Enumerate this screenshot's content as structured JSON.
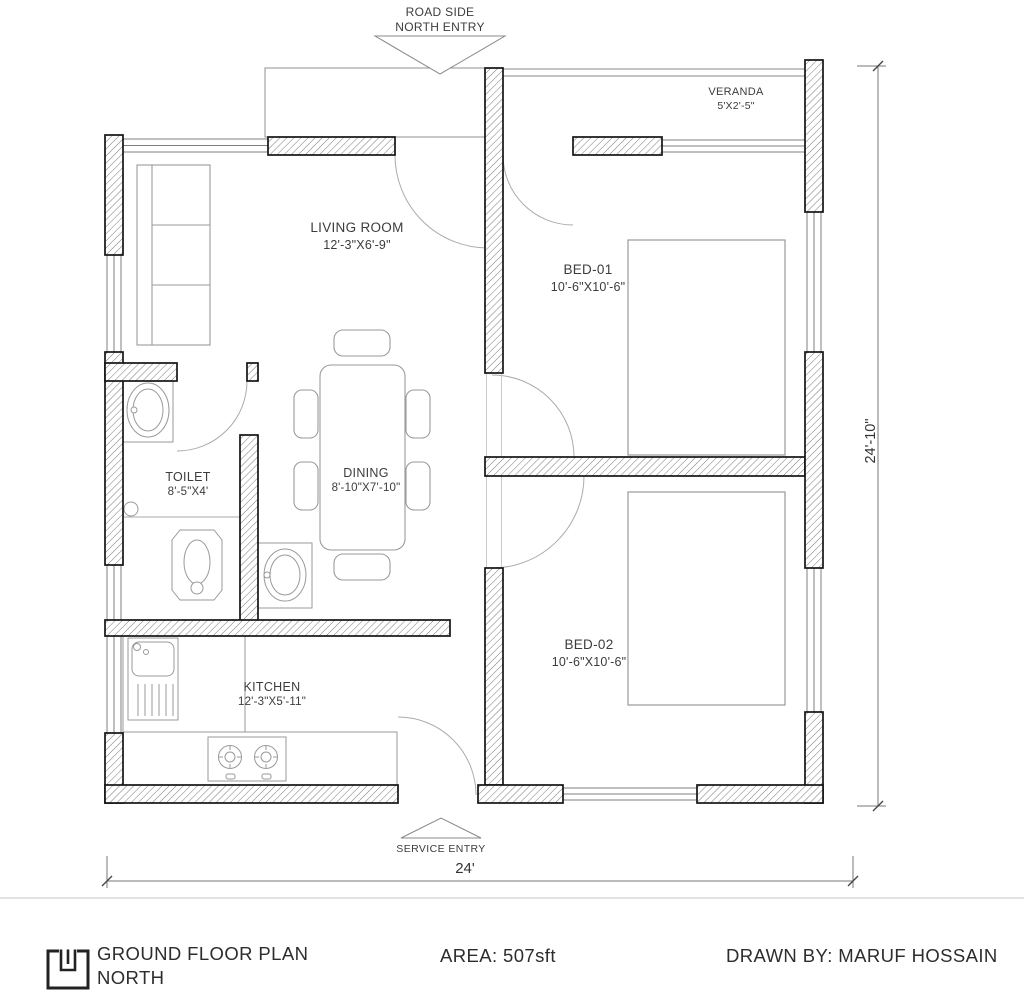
{
  "colors": {
    "wall_line": "#141414",
    "hatch": "#6a6a6a",
    "furniture_line": "#9a9a9a",
    "text": "#3c3c3c"
  },
  "annotations": {
    "north_entry": {
      "line1": "ROAD SIDE",
      "line2": "NORTH ENTRY"
    },
    "service_entry": "SERVICE ENTRY"
  },
  "dimensions": {
    "bottom": "24'",
    "right": "24'-10\""
  },
  "rooms": {
    "living_room": {
      "name": "LIVING ROOM",
      "size": "12'-3\"X6'-9\""
    },
    "veranda": {
      "name": "VERANDA",
      "size": "5'X2'-5\""
    },
    "bed_01": {
      "name": "BED-01",
      "size": "10'-6\"X10'-6\""
    },
    "bed_02": {
      "name": "BED-02",
      "size": "10'-6\"X10'-6\""
    },
    "toilet": {
      "name": "TOILET",
      "size": "8'-5\"X4'"
    },
    "dining": {
      "name": "DINING",
      "size": "8'-10\"X7'-10\""
    },
    "kitchen": {
      "name": "KITCHEN",
      "size": "12'-3\"X5'-11\""
    }
  },
  "title_block": {
    "plan_title": "GROUND FLOOR PLAN",
    "orientation": "NORTH",
    "area": "AREA: 507sft",
    "drawn_by": "DRAWN BY: MARUF HOSSAIN"
  }
}
